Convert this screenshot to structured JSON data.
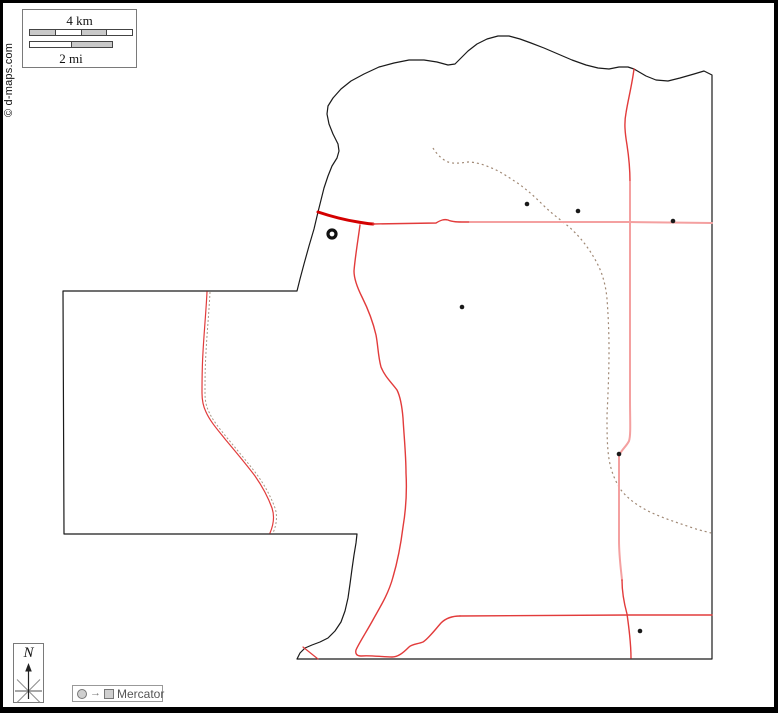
{
  "copyright": {
    "text": "© d-maps.com"
  },
  "scale_bar": {
    "km_label": "4 km",
    "mi_label": "2 mi"
  },
  "north_box": {
    "label": "N"
  },
  "projection_box": {
    "label": "Mercator",
    "arrow_glyph": "→"
  },
  "colors": {
    "frame": "#000000",
    "boundary": "#1a1a1a",
    "road_dark": "#d40000",
    "road_medium": "#e23b3b",
    "road_light": "#f4a0a0",
    "trail": "#a08874"
  },
  "map": {
    "boundary": {
      "d": "M318,212 L321,200 L324,188 L328,176 L332,166 L337,158 L339,151 L338,144 L333,134 L329,124 L327,114 L328,106 L333,98 L341,89 L351,81 L364,74 L379,67 L394,63 L409,60 L424,60 L437,62 L448,65 L455,64 L461,58 L468,51 L477,44 L487,39 L498,36 L509,36 L520,39 L531,43 L544,48 L558,54 L572,60 L586,65 L598,68 L609,69 L619,67 L628,67 L634,69 L646,76 L656,80 L668,81 L680,78 L694,74 L704,71 L712,75 L712,659 L297,659 L300,653 L305,648 L312,645 L320,642 L328,638 L335,631 L341,622 L345,611 L348,598 L350,584 L352,569 L354,555 L356,543 L357,534 L64,534 L63,291 L297,291 L300,279 L304,264 L309,246 L314,229 Z",
      "color": "#1a1a1a",
      "width": 1.2
    },
    "trails": [
      {
        "name": "trail-dotted-main",
        "d": "M433,148 C436,153 441,159 448,162 C454,164 461,163 468,162 C476,162 485,165 494,169 C503,173 511,179 519,184 C527,190 534,196 541,203 C548,210 555,216 562,221 C568,226 574,231 580,238 C587,246 593,255 598,265 C603,275 606,287 607,299 C608,312 609,330 609,350 C609,372 608,395 607,415 C607,432 607,446 609,459 C611,471 615,481 621,490 C628,499 638,506 650,512 C663,518 678,523 693,528 C702,531 708,532 711,533",
        "color": "#a08874",
        "dash": "2 3",
        "width": 1.2
      },
      {
        "name": "trail-dotted-arm",
        "d": "M210,292 C209,312 207,333 206,352 C205,368 205,382 205,393 C205,400 206,406 209,412 C213,421 220,429 228,439 C238,451 249,464 258,476 C265,486 271,497 275,508 C278,517 276,526 273,533",
        "color": "#a89888",
        "dash": "2 2",
        "width": 1
      }
    ],
    "roads": [
      {
        "name": "road-nw-thick",
        "d": "M318,212 C330,216 345,220 358,222 C364,223 369,224 373,224",
        "color": "#d40000",
        "width": 3
      },
      {
        "name": "road-top-horizontal-mid",
        "d": "M373,224 L436,223 C441,220 444,219 448,220 C452,222 458,222 465,222 L470,222",
        "color": "#e23b3b",
        "width": 1.4
      },
      {
        "name": "road-top-horizontal-east",
        "d": "M470,222 L629,222 L712,223",
        "color": "#f4a0a0",
        "width": 2
      },
      {
        "name": "road-center-ns",
        "d": "M360,225 C358,240 355,258 354,271 C354,279 357,287 362,297 C368,309 373,322 376,335 C378,345 378,356 381,367 C385,377 392,383 397,390 C400,396 402,406 403,418 C404,436 406,455 406,473 C407,491 406,509 403,527 C401,543 398,560 393,577 C389,592 382,604 374,618 C367,631 359,643 356,650 C355,654 357,656 361,656 C370,655 382,657 392,657 C398,657 403,653 409,647 C412,644 418,644 423,642 C428,639 434,631 441,623 C446,618 452,616 460,616",
        "color": "#e23b3b",
        "width": 1.4
      },
      {
        "name": "road-bottom-horizontal",
        "d": "M460,616 L629,615 L712,615",
        "color": "#e23b3b",
        "width": 1.4
      },
      {
        "name": "road-east-ns-top",
        "d": "M634,69 C632,85 628,100 626,113 C624,123 625,133 627,145 C629,158 630,170 630,182",
        "color": "#e23b3b",
        "width": 1.4
      },
      {
        "name": "road-east-ns-light",
        "d": "M630,182 L630,222 L630,400 C630,420 631,435 629,441 C626,447 621,450 619,456 L619,540 C619,556 621,570 622,580",
        "color": "#f4a0a0",
        "width": 2
      },
      {
        "name": "road-east-ns-bottom",
        "d": "M622,580 C622,592 624,603 627,614 C629,628 631,643 631,658",
        "color": "#e23b3b",
        "width": 1.4
      },
      {
        "name": "road-west-arm",
        "d": "M207,292 C206,312 204,333 203,352 C202,368 202,382 202,393 C202,400 203,406 206,412 C210,421 217,429 225,439 C235,451 246,464 255,476 C262,486 268,497 272,508 C275,517 273,526 270,533",
        "color": "#e23b3b",
        "width": 1.2
      },
      {
        "name": "road-stub-southwest",
        "d": "M303,647 L318,659",
        "color": "#e23b3b",
        "width": 1.2
      }
    ],
    "towns": [
      {
        "x": 527,
        "y": 204
      },
      {
        "x": 578,
        "y": 211
      },
      {
        "x": 673,
        "y": 221
      },
      {
        "x": 462,
        "y": 307
      },
      {
        "x": 619,
        "y": 454
      },
      {
        "x": 640,
        "y": 631
      }
    ],
    "town_radius": 2.3,
    "town_color": "#1a1a1a",
    "city": {
      "x": 332,
      "y": 234,
      "r": 4,
      "stroke_width": 3.2,
      "color": "#111111"
    }
  }
}
